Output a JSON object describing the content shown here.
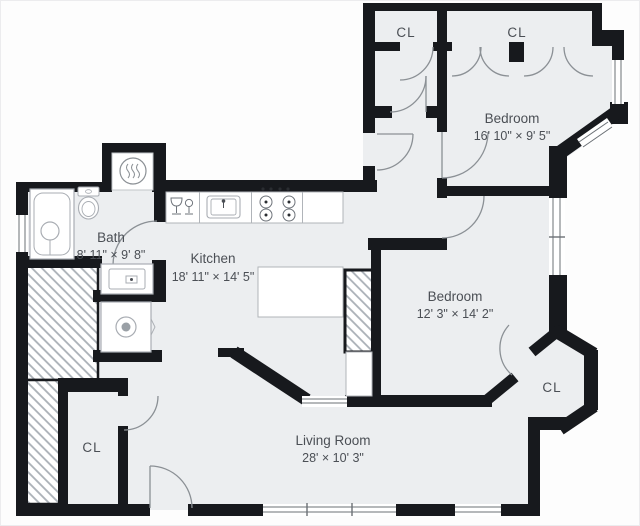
{
  "plan_title": "Apartment floor plan",
  "colors": {
    "wall": "#17191d",
    "floor": "#eceef0",
    "background": "#fdfdfd",
    "label": "#4b4f55",
    "fixture_outline": "#a9adb3",
    "door_arc": "#8b9095",
    "hatch_line": "#aab0b7"
  },
  "rooms": {
    "bath": {
      "name": "Bath",
      "dimensions": "8' 11\" × 9' 8\""
    },
    "kitchen": {
      "name": "Kitchen",
      "dimensions": "18' 11\" × 14' 5\""
    },
    "bedroom_top": {
      "name": "Bedroom",
      "dimensions": "16' 10\" × 9' 5\""
    },
    "bedroom_middle": {
      "name": "Bedroom",
      "dimensions": "12' 3\" × 14' 2\""
    },
    "living_room": {
      "name": "Living Room",
      "dimensions": "28' × 10' 3\""
    },
    "closet_hall": {
      "label": "CL"
    },
    "closet_bedroom": {
      "label": "CL"
    },
    "closet_bay": {
      "label": "CL"
    },
    "closet_entry": {
      "label": "CL"
    }
  },
  "fixtures": {
    "bathtub": "bathtub with shower",
    "toilet": "toilet",
    "vanity": "vanity sink",
    "washer": "washing machine",
    "radiator": "radiator",
    "dishwasher": "dishwasher",
    "kitchen_sink": "kitchen sink",
    "stove": "4-burner stove",
    "island": "kitchen island"
  }
}
